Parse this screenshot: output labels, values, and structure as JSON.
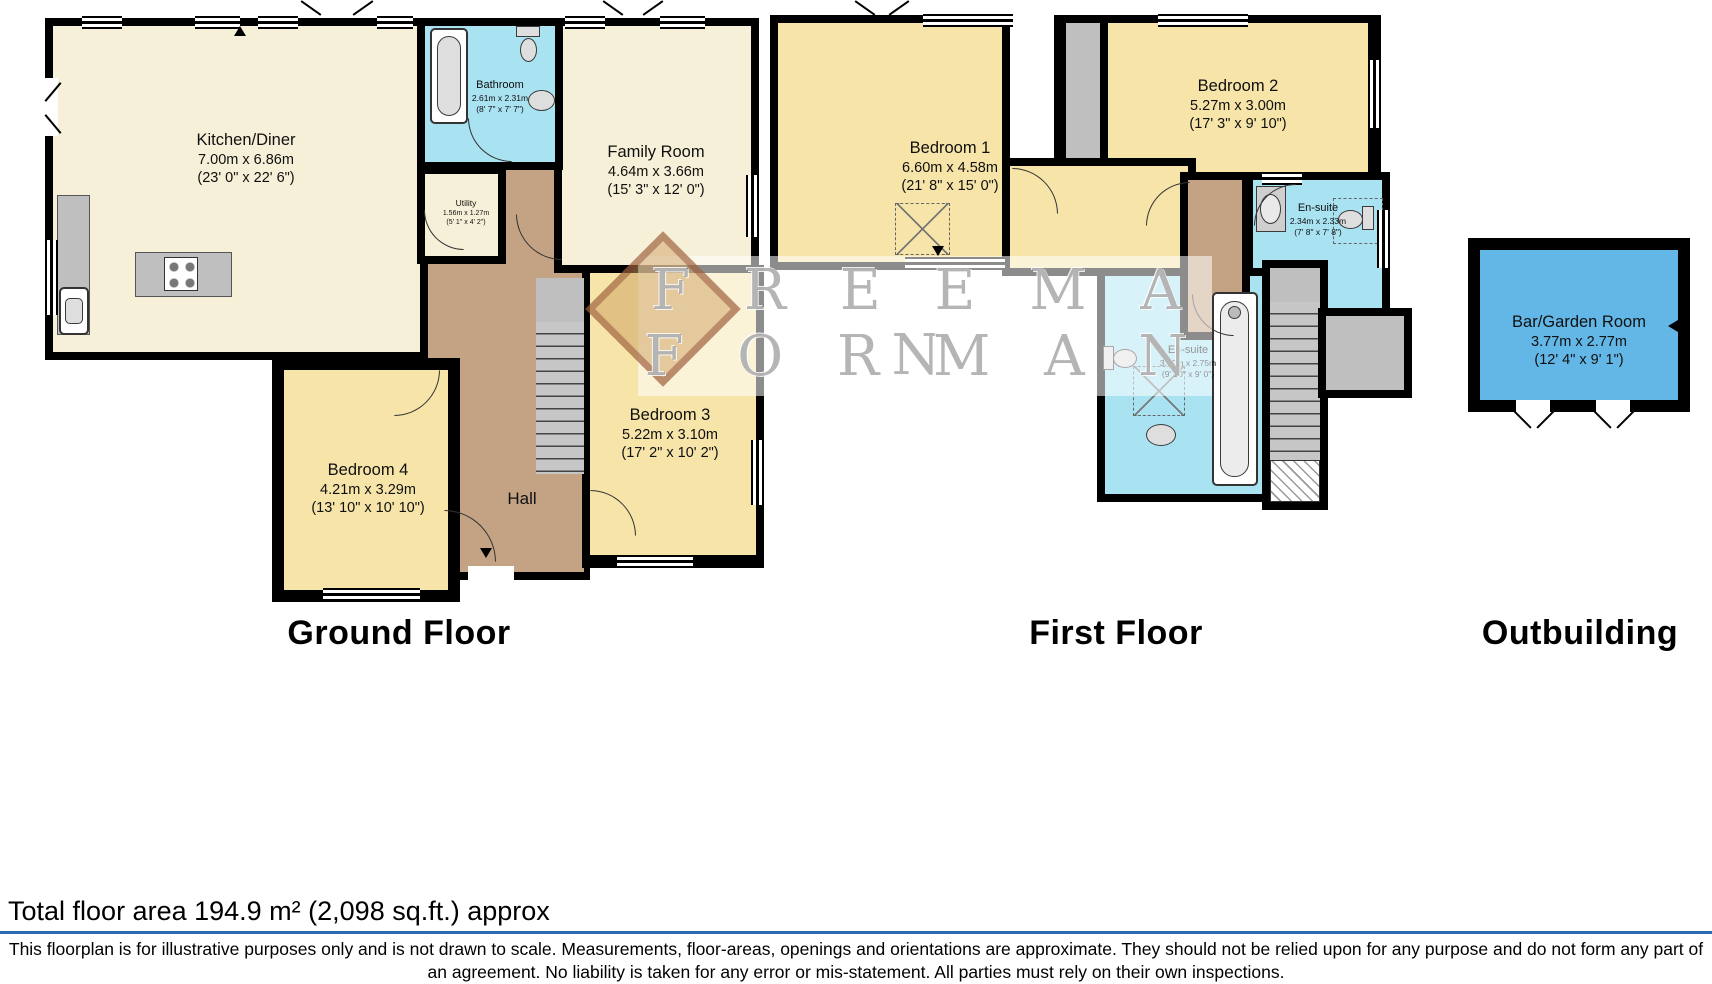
{
  "colors": {
    "wall": "#000000",
    "cream": "#f7f0d8",
    "yellow": "#f6e4a9",
    "cyan": "#a9e2f1",
    "blue": "#62b7e6",
    "hall": "#c4a384",
    "gray": "#bfbfbf",
    "stair": "#c6c6c6",
    "divider": "#2a6ab3"
  },
  "watermark": {
    "line1": "F R E E M A N",
    "line2": "F O R M A N"
  },
  "floors": {
    "ground": {
      "label": "Ground Floor"
    },
    "first": {
      "label": "First Floor"
    },
    "outbuilding": {
      "label": "Outbuilding"
    }
  },
  "rooms": {
    "kitchen": {
      "name": "Kitchen/Diner",
      "metric": "7.00m x 6.86m",
      "imperial": "(23' 0\" x 22' 6\")"
    },
    "bathroom": {
      "name": "Bathroom",
      "metric": "2.61m x 2.31m",
      "imperial": "(8' 7\" x 7' 7\")"
    },
    "family": {
      "name": "Family Room",
      "metric": "4.64m x 3.66m",
      "imperial": "(15' 3\" x 12' 0\")"
    },
    "utility": {
      "name": "Utility",
      "metric": "1.56m x 1.27m",
      "imperial": "(5' 1\" x 4' 2\")"
    },
    "hall": {
      "name": "Hall"
    },
    "bedroom3": {
      "name": "Bedroom 3",
      "metric": "5.22m x 3.10m",
      "imperial": "(17' 2\" x 10' 2\")"
    },
    "bedroom4": {
      "name": "Bedroom 4",
      "metric": "4.21m x 3.29m",
      "imperial": "(13' 10\" x 10' 10\")"
    },
    "bedroom1": {
      "name": "Bedroom 1",
      "metric": "6.60m x 4.58m",
      "imperial": "(21' 8\" x 15' 0\")"
    },
    "bedroom2": {
      "name": "Bedroom 2",
      "metric": "5.27m x 3.00m",
      "imperial": "(17' 3\" x 9' 10\")"
    },
    "ensuite1": {
      "name": "En-suite",
      "metric": "3.00m x 2.75m",
      "imperial": "(9' 10\" x 9' 0\")"
    },
    "ensuite2": {
      "name": "En-suite",
      "metric": "2.34m x 2.33m",
      "imperial": "(7' 8\" x 7' 8\")"
    },
    "bar": {
      "name": "Bar/Garden Room",
      "metric": "3.77m x 2.77m",
      "imperial": "(12' 4\" x 9' 1\")"
    }
  },
  "footer": {
    "total_area": "Total floor area 194.9 m² (2,098 sq.ft.) approx",
    "disclaimer": "This floorplan is for illustrative purposes only and is not drawn to scale. Measurements, floor-areas, openings and orientations are approximate. They should not be relied upon for any purpose and do not form any part of an agreement. No liability is taken for any error or mis-statement. All parties must rely on their own inspections."
  }
}
